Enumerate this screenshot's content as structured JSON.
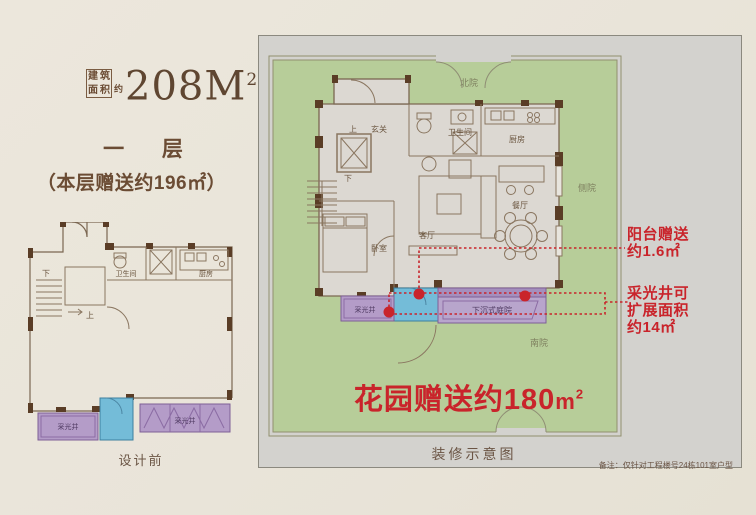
{
  "header": {
    "area_box_chars": [
      "建",
      "筑",
      "面",
      "积"
    ],
    "approx_char": "约",
    "area_value": "208M",
    "area_sup": "2",
    "floor_title": "一 层",
    "floor_subtitle": "（本层赠送约196㎡）"
  },
  "left_plan": {
    "labels": {
      "down": "下",
      "up": "上",
      "bathroom": "卫生间",
      "kitchen": "厨房",
      "lightwell_left": "采光井",
      "lightwell_right": "采光井"
    },
    "caption": "设计前"
  },
  "right_plan": {
    "yards": {
      "north": "北院",
      "side": "侧院",
      "south": "南院"
    },
    "rooms": {
      "up": "上",
      "foyer": "玄关",
      "down": "下",
      "bathroom": "卫生间",
      "kitchen": "厨房",
      "dining": "餐厅",
      "living": "客厅",
      "bedroom": "卧室",
      "lightwell": "采光井",
      "sunken_courtyard": "下沉式庭院"
    },
    "garden_gift": {
      "text": "花园赠送约180",
      "unit": "m",
      "sup": "2"
    },
    "caption": "装修示意图",
    "note": "备注：仅针对工程楼号24栋101室户型"
  },
  "annotations": {
    "balcony": {
      "line1": "阳台赠送",
      "line2": "约1.6㎡"
    },
    "lightwell": {
      "line1": "采光井可",
      "line2": "扩展面积",
      "line3": "约14㎡"
    }
  },
  "colors": {
    "page_bg": "#e9e4d9",
    "panel_bg": "#d3d2ce",
    "garden_green": "#b7cd99",
    "lightwell_purple": "#b49cc8",
    "balcony_blue": "#74bcd8",
    "wall_brown": "#5a3d26",
    "accent_red": "#c9242b",
    "text_brown": "#6b4c34"
  }
}
